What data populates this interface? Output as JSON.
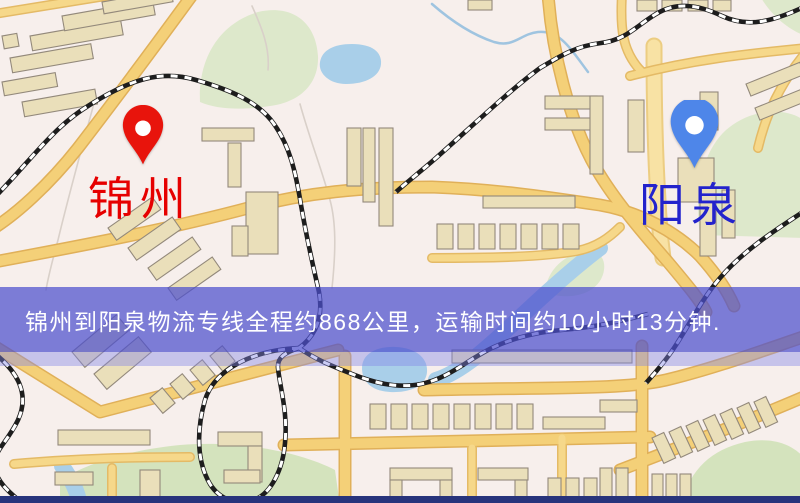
{
  "banner": {
    "text": "锦州到阳泉物流专线全程约868公里，运输时间约10小时13分钟.",
    "text_color": "#ffffff",
    "background_rgba": "rgba(76,79,205,0.72)",
    "background_rgba_light": "rgba(130,134,230,0.42)",
    "background_hex": "#4c4fcd"
  },
  "route": {
    "origin_city": "锦州",
    "destination_city": "阳泉",
    "distance_text": "约868公里",
    "duration_text": "约10小时13分钟"
  },
  "map": {
    "markers": [
      {
        "id": "origin",
        "city": "锦州",
        "pin": "red-pin",
        "pin_color": "#e8140c",
        "label_color": "#e60000"
      },
      {
        "id": "destination",
        "city": "阳泉",
        "pin": "blue-pin",
        "pin_color": "#4e86e9",
        "label_color": "#2323cc"
      }
    ],
    "palette": {
      "background": "#f7efec",
      "road_fill": "#f4d078",
      "road_casing": "#e0b059",
      "building_fill": "#eadfba",
      "building_stroke": "#93897b",
      "green": "#dde8cb",
      "water": "#a9cfe9",
      "rail": "#1d1d1d",
      "bottom_strip": "#28347c"
    }
  }
}
